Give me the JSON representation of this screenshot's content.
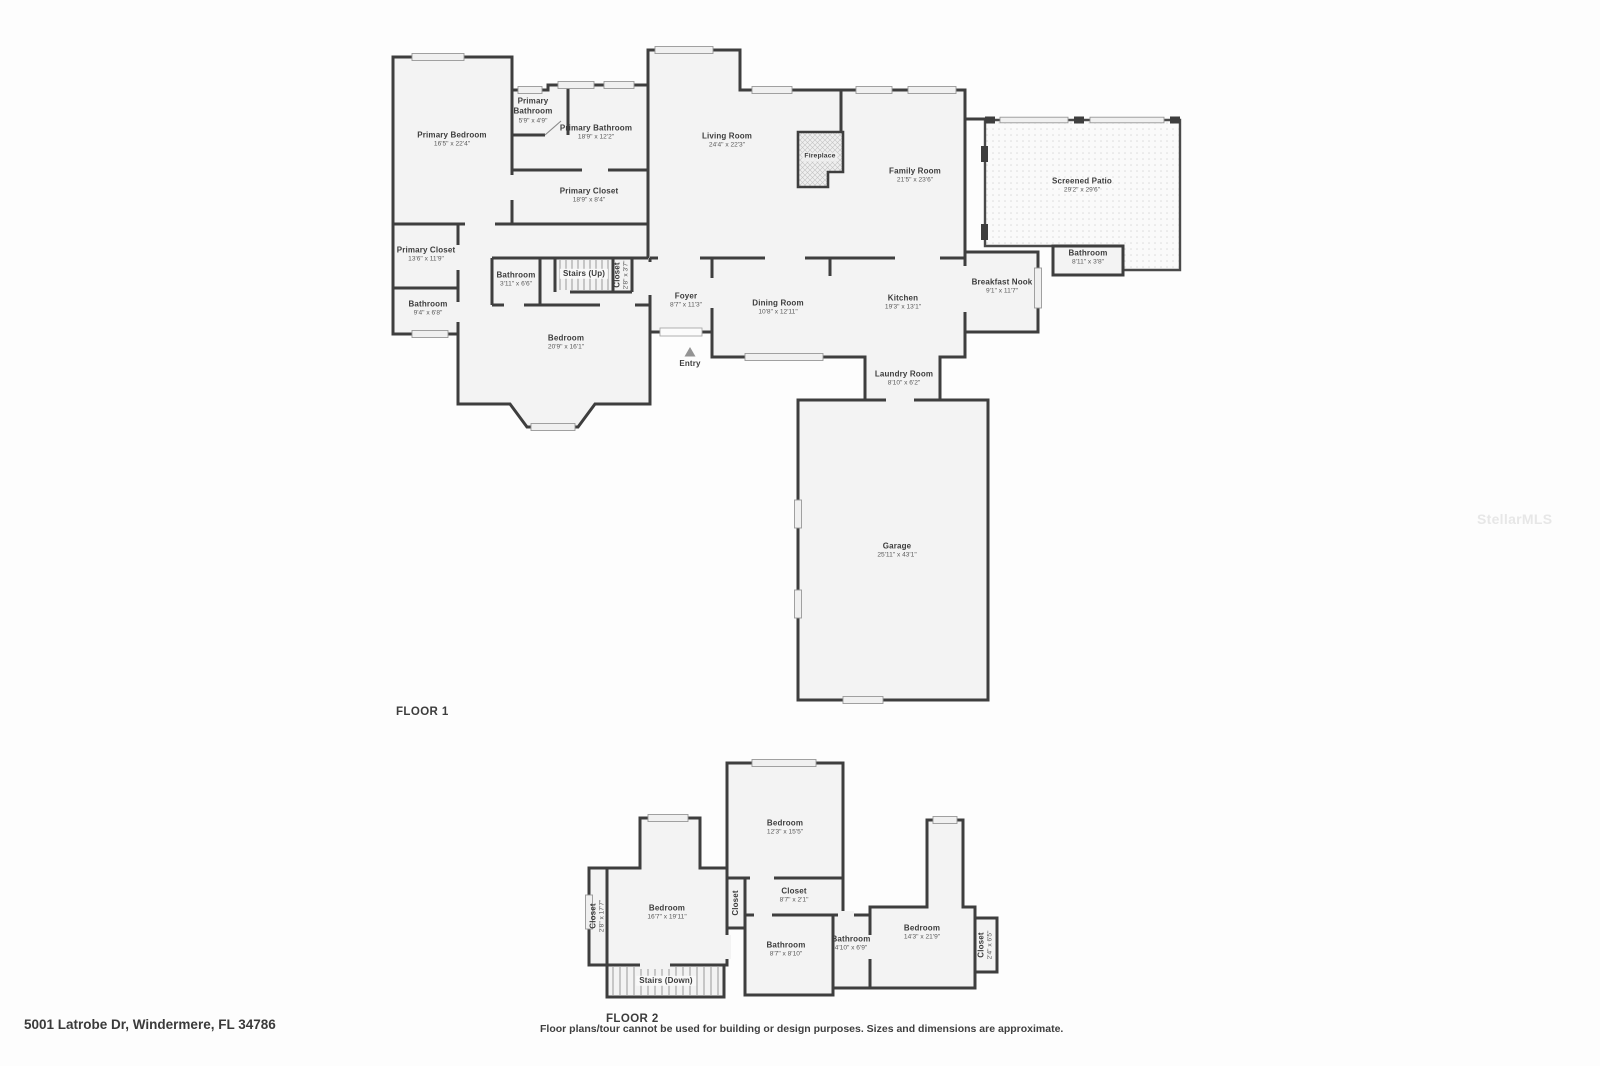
{
  "address": "5001 Latrobe Dr, Windermere, FL 34786",
  "disclaimer": "Floor plans/tour cannot be used for building or design purposes. Sizes and dimensions are approximate.",
  "watermark": "StellarMLS",
  "colors": {
    "wall": "#3e3e3e",
    "floor": "#f3f3f3",
    "page": "#fdfdfd",
    "text": "#3c3c3c"
  },
  "floors": [
    {
      "id": "floor1",
      "label": "FLOOR 1",
      "rooms": [
        {
          "name": "Primary Bedroom",
          "dims": "16'5\" x 22'4\"",
          "x": 452,
          "y": 140
        },
        {
          "name": "Primary Bathroom",
          "dims": "5'9\" x 4'9\"",
          "x": 533,
          "y": 111,
          "wrap": true
        },
        {
          "name": "Primary Bathroom",
          "dims": "18'9\" x 12'2\"",
          "x": 596,
          "y": 133
        },
        {
          "name": "Primary Closet",
          "dims": "18'9\" x 8'4\"",
          "x": 589,
          "y": 196
        },
        {
          "name": "Primary Closet",
          "dims": "13'6\" x 11'9\"",
          "x": 426,
          "y": 255
        },
        {
          "name": "Bathroom",
          "dims": "3'11\" x 6'6\"",
          "x": 516,
          "y": 280
        },
        {
          "name": "Stairs (Up)",
          "x": 584,
          "y": 274,
          "bg": true
        },
        {
          "name": "Closet",
          "dims": "2'8\" x 3'7\"",
          "x": 622,
          "y": 275,
          "rot": true
        },
        {
          "name": "Bathroom",
          "dims": "9'4\" x 6'8\"",
          "x": 428,
          "y": 309
        },
        {
          "name": "Bedroom",
          "dims": "20'9\" x 16'1\"",
          "x": 566,
          "y": 343
        },
        {
          "name": "Foyer",
          "dims": "8'7\" x 11'3\"",
          "x": 686,
          "y": 301
        },
        {
          "name": "Entry",
          "x": 690,
          "y": 364
        },
        {
          "name": "Living Room",
          "dims": "24'4\" x 22'3\"",
          "x": 727,
          "y": 141
        },
        {
          "name": "Fireplace",
          "x": 820,
          "y": 157,
          "tiny": true
        },
        {
          "name": "Family Room",
          "dims": "21'5\" x 23'6\"",
          "x": 915,
          "y": 176
        },
        {
          "name": "Dining Room",
          "dims": "10'8\" x 12'11\"",
          "x": 778,
          "y": 308
        },
        {
          "name": "Kitchen",
          "dims": "19'3\" x 13'1\"",
          "x": 903,
          "y": 303
        },
        {
          "name": "Breakfast Nook",
          "dims": "9'1\" x 11'7\"",
          "x": 1002,
          "y": 287
        },
        {
          "name": "Bathroom",
          "dims": "8'11\" x 3'8\"",
          "x": 1088,
          "y": 258
        },
        {
          "name": "Screened Patio",
          "dims": "29'2\" x 29'6\"",
          "x": 1082,
          "y": 186
        },
        {
          "name": "Laundry Room",
          "dims": "8'10\" x 6'2\"",
          "x": 904,
          "y": 379
        },
        {
          "name": "Garage",
          "dims": "25'11\" x 43'1\"",
          "x": 897,
          "y": 551
        }
      ]
    },
    {
      "id": "floor2",
      "label": "FLOOR 2",
      "rooms": [
        {
          "name": "Bedroom",
          "dims": "16'7\" x 19'11\"",
          "x": 667,
          "y": 913
        },
        {
          "name": "Closet",
          "dims": "2'8\" x 17'7\"",
          "x": 598,
          "y": 916,
          "rot": true
        },
        {
          "name": "Closet",
          "x": 736,
          "y": 903,
          "rot": true
        },
        {
          "name": "Bedroom",
          "dims": "12'3\" x 15'5\"",
          "x": 785,
          "y": 828
        },
        {
          "name": "Closet",
          "dims": "8'7\" x 2'1\"",
          "x": 794,
          "y": 896
        },
        {
          "name": "Bathroom",
          "dims": "8'7\" x 8'10\"",
          "x": 786,
          "y": 950
        },
        {
          "name": "Bathroom",
          "dims": "4'10\" x 6'9\"",
          "x": 851,
          "y": 944
        },
        {
          "name": "Bedroom",
          "dims": "14'3\" x 21'9\"",
          "x": 922,
          "y": 933
        },
        {
          "name": "Closet",
          "dims": "2'4\" x 6'5\"",
          "x": 986,
          "y": 945,
          "rot": true
        },
        {
          "name": "Stairs (Down)",
          "x": 666,
          "y": 981,
          "bg": true
        }
      ]
    }
  ]
}
